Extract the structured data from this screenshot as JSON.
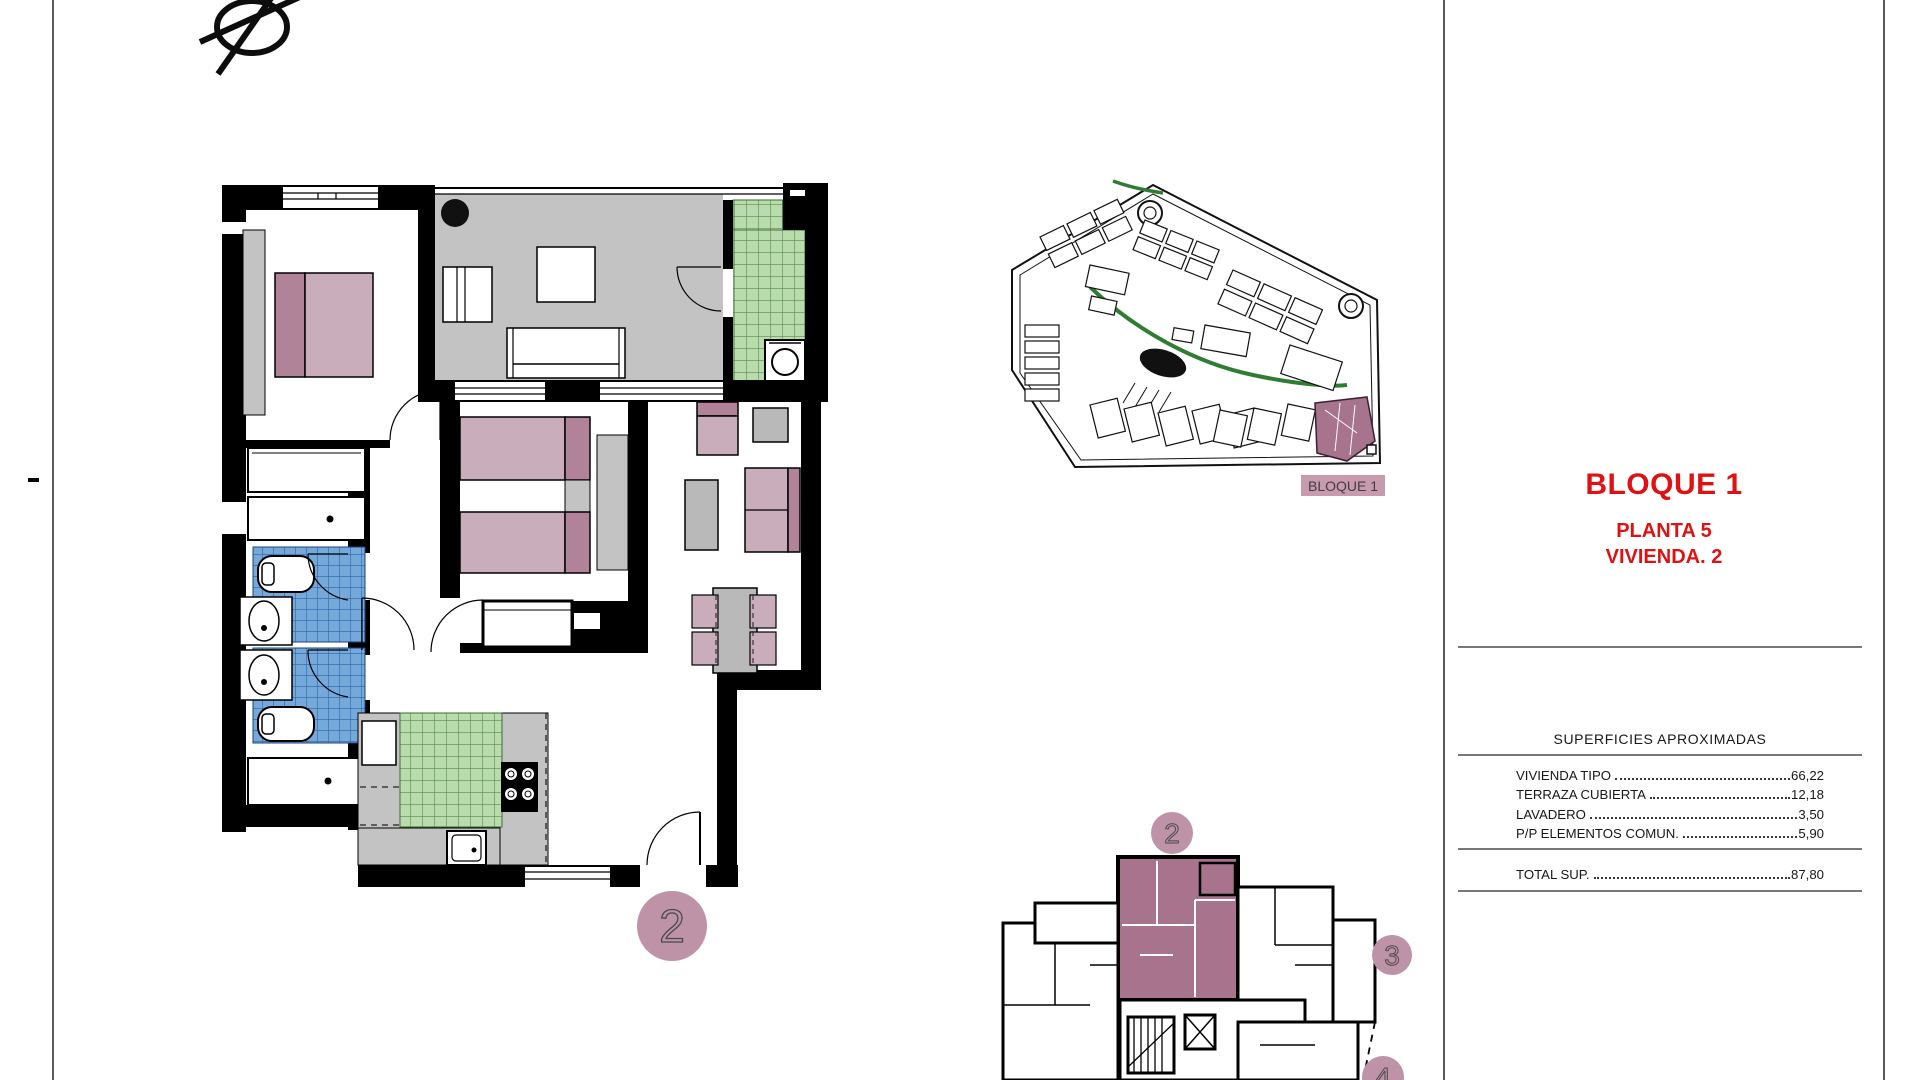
{
  "sheet": {
    "type": "architectural floor plan sheet",
    "unit_badge": "2",
    "panel": {
      "title": "BLOQUE 1",
      "subtitle1": "PLANTA 5",
      "subtitle2": "VIVIENDA. 2",
      "table": {
        "header": "SUPERFICIES APROXIMADAS",
        "rows": [
          {
            "label": "VIVIENDA TIPO",
            "value": "66,22"
          },
          {
            "label": "TERRAZA CUBIERTA",
            "value": "12,18"
          },
          {
            "label": "LAVADERO",
            "value": "3,50"
          },
          {
            "label": "P/P ELEMENTOS COMUN.",
            "value": "5,90"
          }
        ],
        "total": {
          "label": "TOTAL SUP.",
          "value": "87,80"
        }
      }
    },
    "site_plan": {
      "label": "BLOQUE 1"
    },
    "key_plan": {
      "unit2": "2",
      "unit3": "3",
      "unit4": "4"
    },
    "colors": {
      "accent_red": "#de1212",
      "mauve_furniture": "#c9adbb",
      "mauve_dark": "#b08399",
      "unit_circle": "#bf93a7",
      "highlight_block": "#a8738c",
      "label_bg": "#c89aae",
      "terrace_gray": "#c3c3c3",
      "furniture_gray": "#b9b9b9",
      "tile_green": "#b9dcac",
      "tile_green_line": "#5c8a52",
      "tile_blue": "#74a9d9",
      "tile_blue_line": "#2f62a8",
      "wall_black": "#000000"
    }
  }
}
